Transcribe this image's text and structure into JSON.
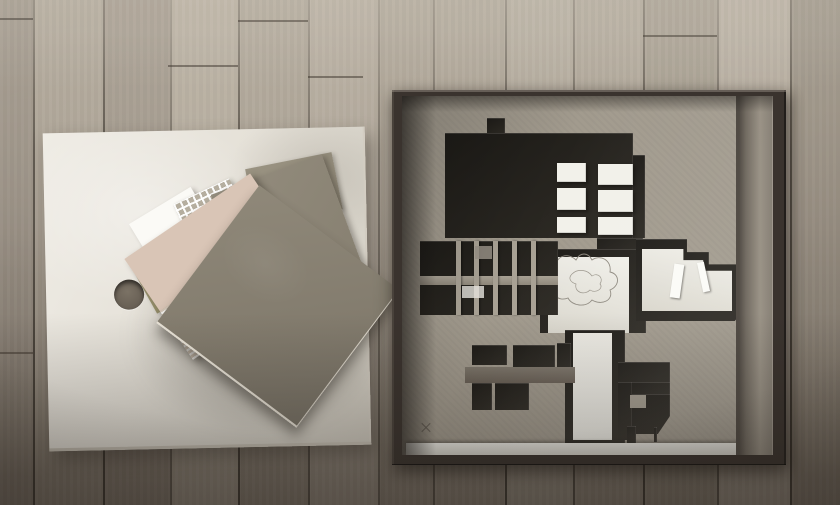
{
  "scene": {
    "description": "Overhead photograph of architectural model parts on a wooden plank floor: left, a square plywood base board with a drilled finger hole and a fanned stack of material sample sheets (grey chipboard squares, corrugated pink-cream card, white card, olive card, white mesh sheet); right, a dark-stained wooden box whose chipboard inlay is laser-cut as a building floor plan with dark recessed rooms, a central white corridor bearing a pencil-sketched pond contour, rows of small cells, stepped white-floored halls, six white foam blocks and a white base strip along the bottom edge.",
    "objects": [
      "wood-plank-floor",
      "plywood-base-board",
      "finger-hole",
      "material-sample-stack",
      "wooden-model-box",
      "chipboard-floorplan-inlay",
      "white-foam-blocks",
      "pencil-sketch-contour"
    ],
    "counts": {
      "sample_sheets": 7,
      "white_foam_blocks": 6
    }
  },
  "palette": {
    "floor-top": "#b8afa1",
    "floor-mid": "#a39a8d",
    "floor-bottom": "#766d62",
    "seam": "#453f37",
    "board": "#eae6dd",
    "box-frame": "#3a332e",
    "box-interior": "#a29b8e",
    "cut-dark": "#232019",
    "white-foam": "#f2f1ea",
    "sheet-white": "#fbfaf6",
    "sheet-olive": "#959070",
    "sheet-pink": "#d9c5b6",
    "sheet-cream": "#e9dfd1",
    "sheet-mesh": "#b5ae9f",
    "pencil": "#8f8a80"
  }
}
